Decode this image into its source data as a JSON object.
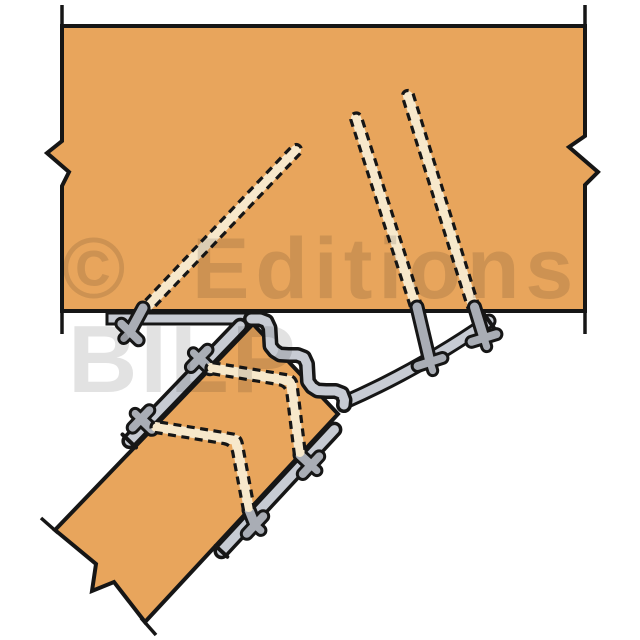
{
  "watermark": {
    "copyright_symbol": "©",
    "publisher_word": "Editions",
    "publisher_word2": "BILP"
  },
  "colors": {
    "bg": "#FFFFFF",
    "wood": "#E8A55C",
    "outline": "#161616",
    "metal_light": "#C7CBD3",
    "metal_mid": "#A9ADB5",
    "nail_cream": "#F7E8CB",
    "watermark": "#E2E2E2"
  }
}
